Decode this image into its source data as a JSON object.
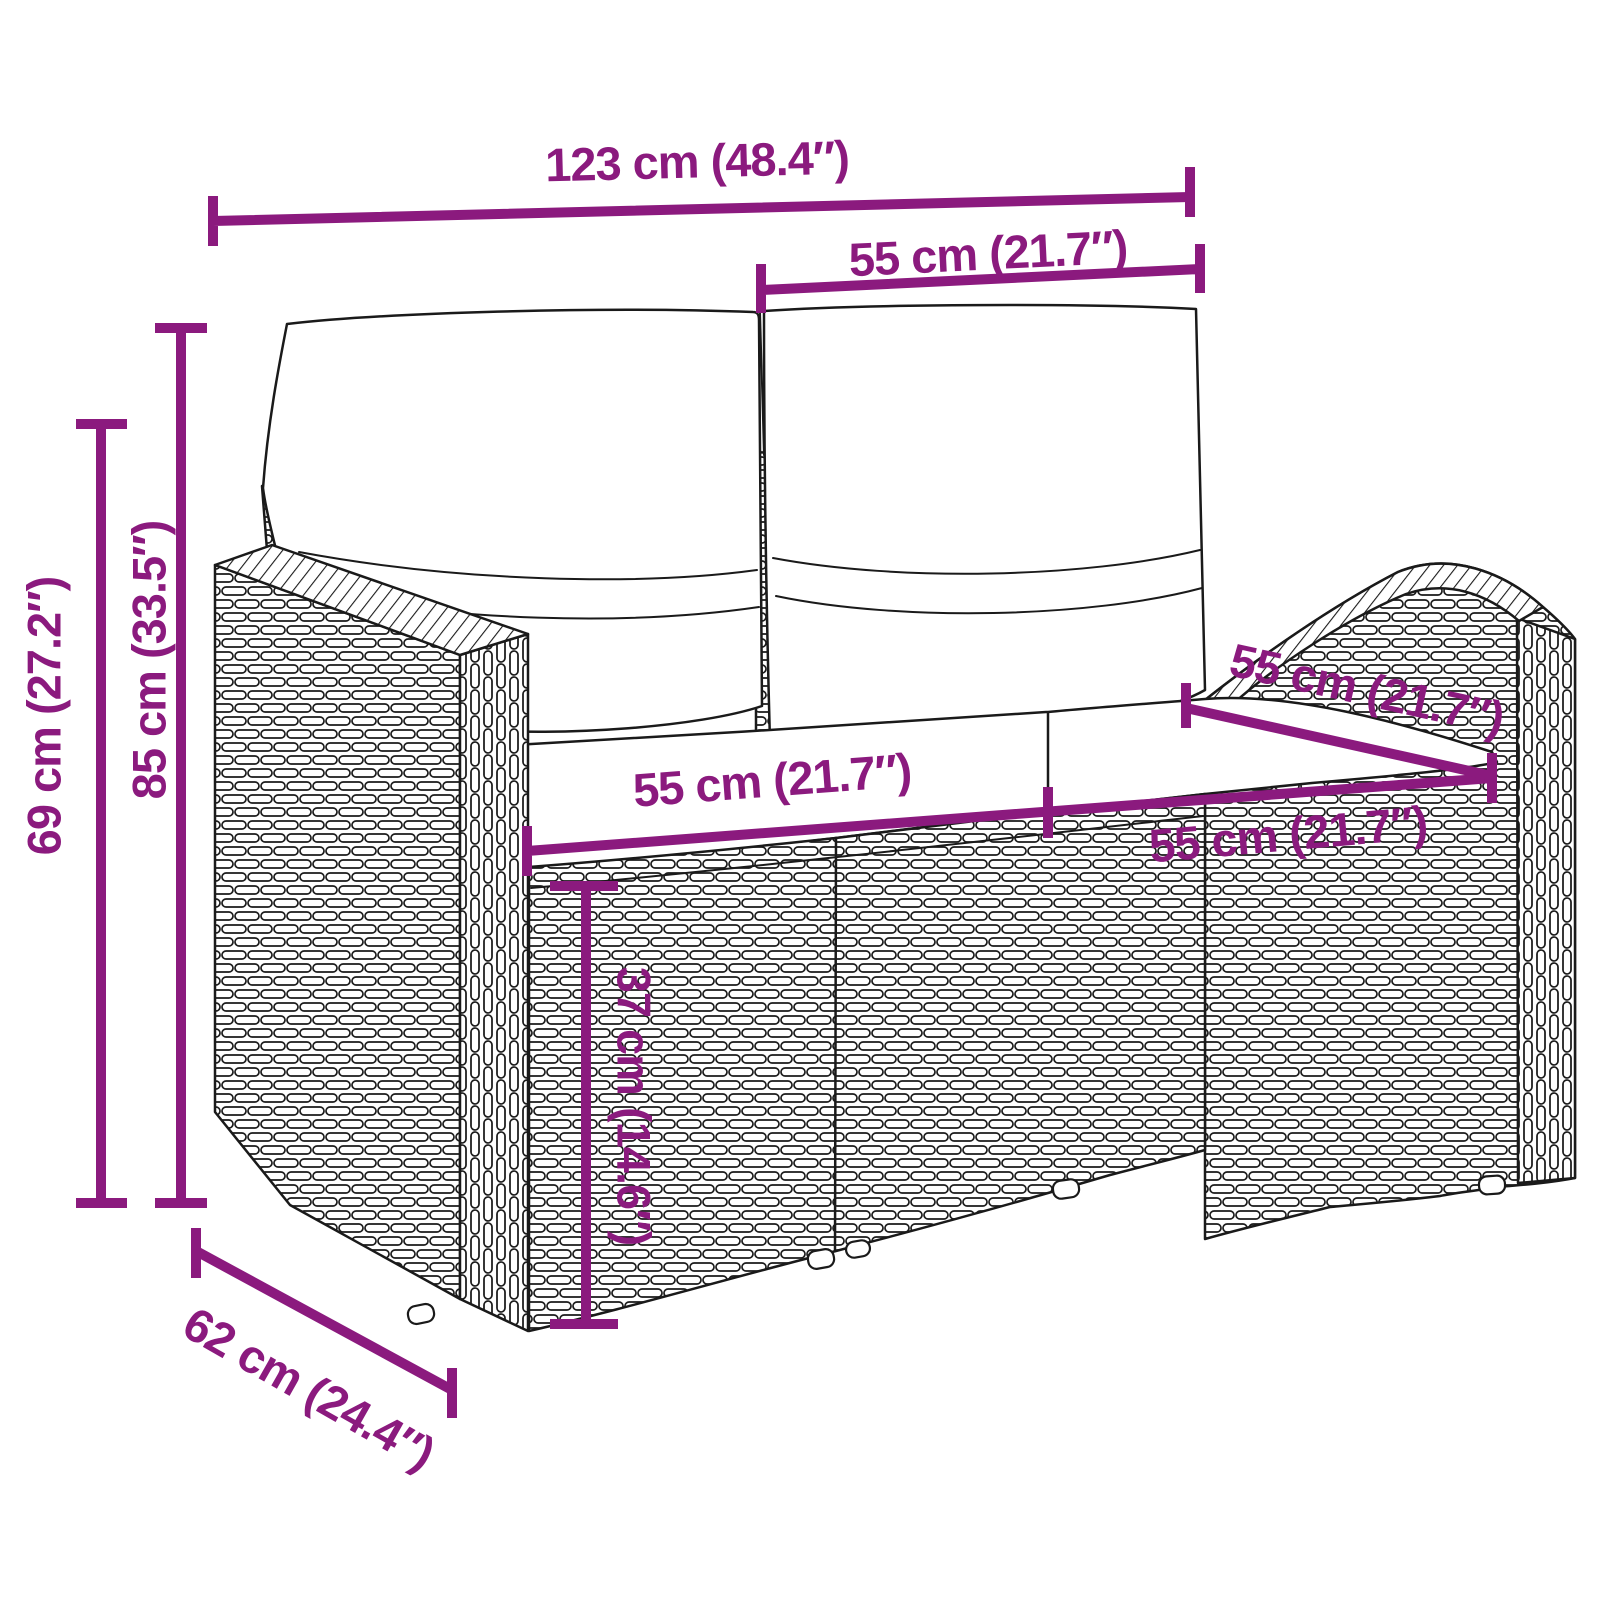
{
  "diagram": {
    "kind": "product-dimension-diagram",
    "subject": "rattan-garden-2-seater-sofa-with-cushions",
    "background_color": "#FFFFFF",
    "dimension_color": "#8B1A7E",
    "line_art_color": "#1A1A1A",
    "dims": {
      "overall_width": "123 cm (48.4″)",
      "back_cushion_width": "55 cm (21.7″)",
      "height_total": "85 cm (33.5″)",
      "height_armrest": "69 cm (27.2″)",
      "seat_width_left": "55 cm (21.7″)",
      "seat_width_right": "55 cm (21.7″)",
      "seat_depth": "55 cm (21.7″)",
      "seat_height": "37 cm (14.6″)",
      "depth_total": "62 cm (24.4″)"
    }
  }
}
